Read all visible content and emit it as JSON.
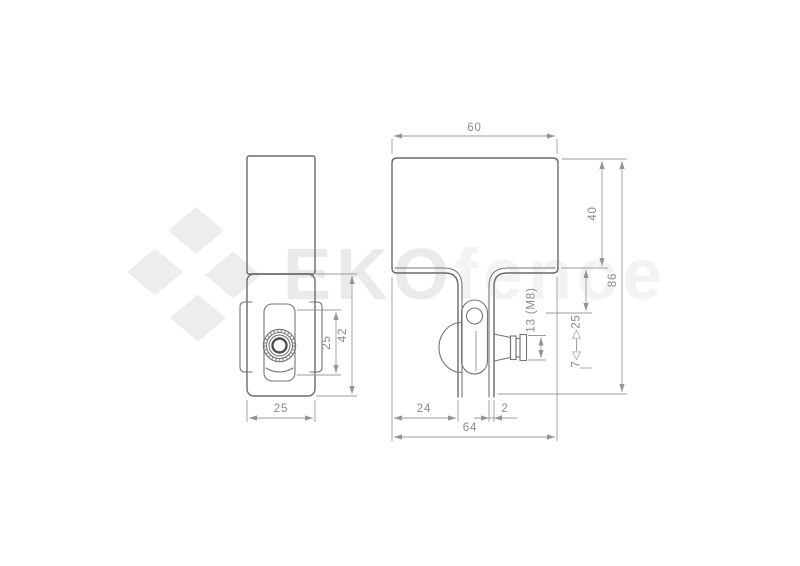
{
  "watermark": {
    "brand_bold": "EKO",
    "brand_light": "fence",
    "logo_color": "#ededed",
    "text_bold_color": "#eaeaea",
    "text_light_color": "#f3f3f3"
  },
  "palette": {
    "part_line": "#6a6a6a",
    "dimension_line": "#9b9b9b",
    "dimension_text": "#8a8a8a",
    "background": "#ffffff"
  },
  "side_view": {
    "dims": {
      "bottom_width": "25",
      "clamp_height": "25",
      "lower_body_height": "42"
    }
  },
  "front_view": {
    "dims": {
      "top_width": "60",
      "plate_height": "40",
      "total_height": "86",
      "adjust_range": "7◁—▷25",
      "bolt_size": "13 (M8)",
      "left_offset": "24",
      "wall_thickness": "2",
      "bottom_width": "64"
    }
  }
}
